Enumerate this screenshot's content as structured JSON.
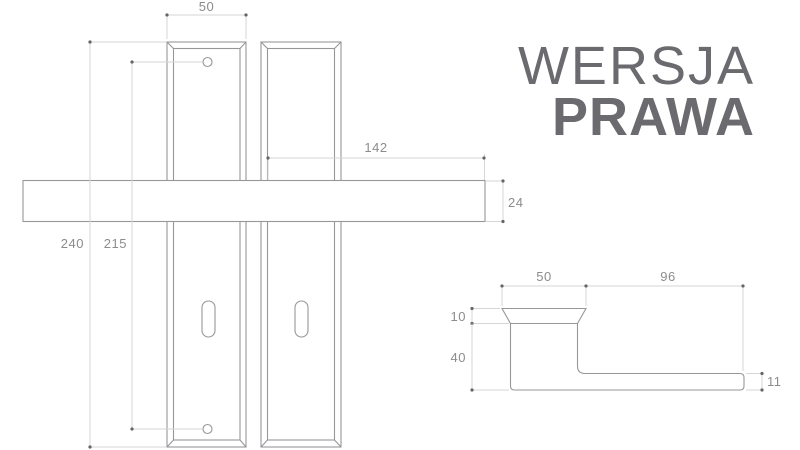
{
  "title": {
    "line1": "WERSJA",
    "line2": "PRAWA"
  },
  "colors": {
    "background": "#ffffff",
    "object_line": "#97979a",
    "dimension_line": "#d6d6d8",
    "dimension_text": "#8c8c8f",
    "dot": "#646467",
    "title_text": "#6b6a6e"
  },
  "front_view": {
    "dimensions": {
      "plate_width": "50",
      "handle_length": "142",
      "handle_thickness": "24",
      "plate_height": "240",
      "screw_hole_spacing": "215"
    }
  },
  "side_view": {
    "dimensions": {
      "rose_width": "50",
      "lever_length": "96",
      "rose_height": "10",
      "neck_height": "40",
      "lever_end_thickness": "11"
    }
  }
}
